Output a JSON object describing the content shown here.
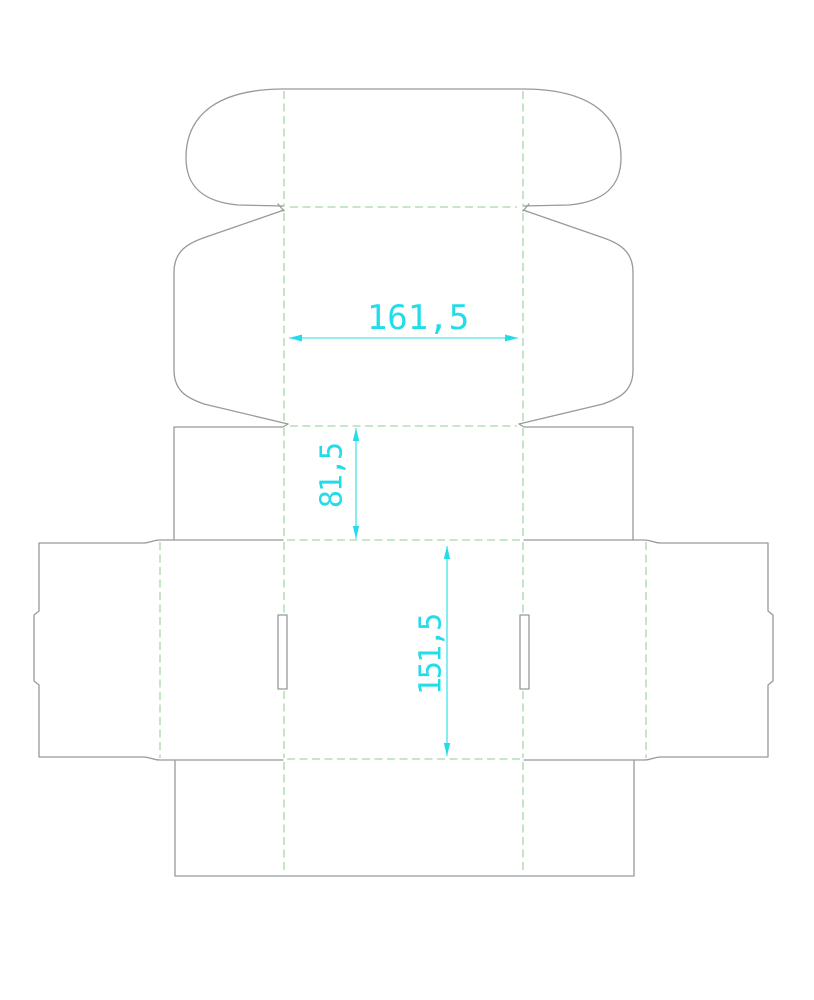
{
  "dimensions": {
    "width": {
      "label": "161,5",
      "value": 161.5
    },
    "lid_depth": {
      "label": "81,5",
      "value": 81.5
    },
    "length": {
      "label": "151,5",
      "value": 151.5
    }
  },
  "colors": {
    "background": "#ffffff",
    "cut_line": "#98999b",
    "fold_line": "#a6d7a6",
    "dimension": "#22dce8"
  }
}
